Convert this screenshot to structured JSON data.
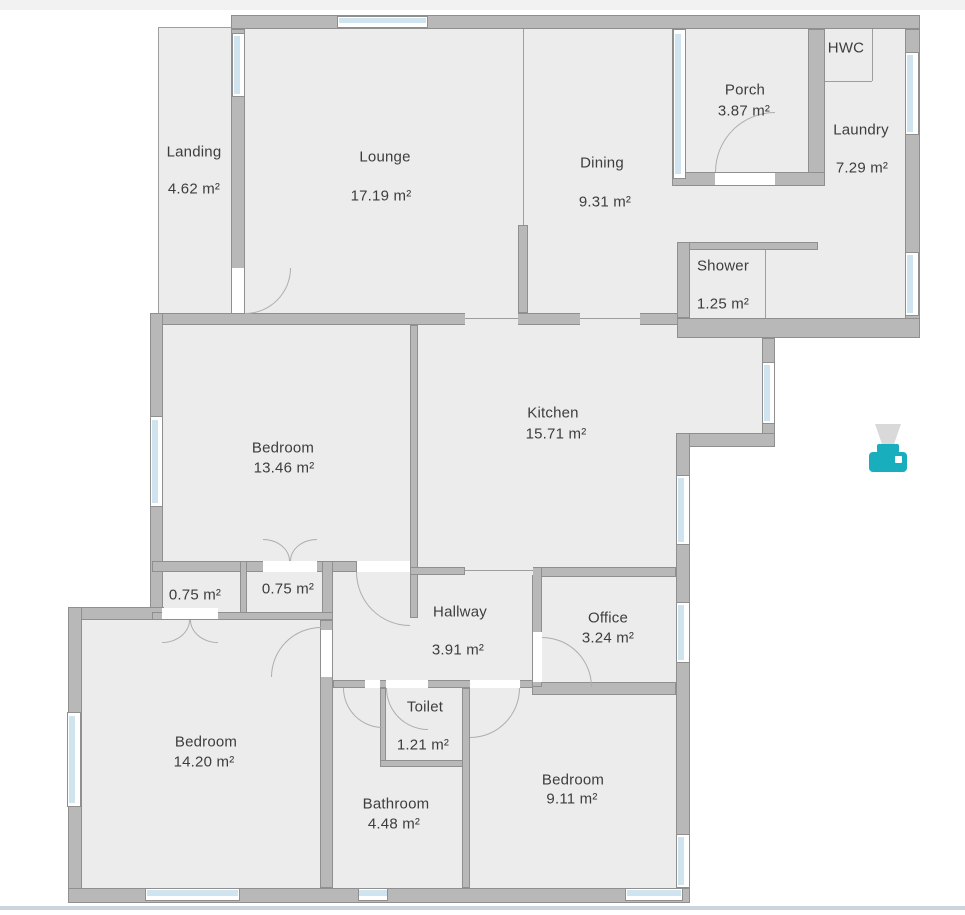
{
  "app": {
    "view": "floor-plan-canvas",
    "units": "m²"
  },
  "colors": {
    "floor": "#ececec",
    "wall": "#b8b8b8",
    "wall_border": "#8f8f8f",
    "window_glass": "#cfe4ee",
    "door_arc": "#aeaeae",
    "text": "#3d3d3d",
    "printer_teal": "#18aebe",
    "top_border": "#f2f2f2",
    "bottom_divider": "#ccd6da"
  },
  "rooms": [
    {
      "label": "Landing",
      "area": "4.62 m²",
      "lx": 194,
      "ly": 152,
      "ax": 194,
      "ay": 189
    },
    {
      "label": "Lounge",
      "area": "17.19 m²",
      "lx": 385,
      "ly": 157,
      "ax": 381,
      "ay": 196
    },
    {
      "label": "Dining",
      "area": "9.31 m²",
      "lx": 602,
      "ly": 163,
      "ax": 605,
      "ay": 202
    },
    {
      "label": "Porch",
      "area": "3.87 m²",
      "lx": 745,
      "ly": 90,
      "ax": 744,
      "ay": 111
    },
    {
      "label": "HWC",
      "area": "",
      "lx": 846,
      "ly": 48,
      "ax": 0,
      "ay": 0
    },
    {
      "label": "Laundry",
      "area": "7.29 m²",
      "lx": 861,
      "ly": 130,
      "ax": 862,
      "ay": 168
    },
    {
      "label": "Shower",
      "area": "1.25 m²",
      "lx": 723,
      "ly": 266,
      "ax": 723,
      "ay": 304
    },
    {
      "label": "Bedroom",
      "area": "13.46 m²",
      "lx": 283,
      "ly": 448,
      "ax": 284,
      "ay": 468
    },
    {
      "label": "Kitchen",
      "area": "15.71 m²",
      "lx": 553,
      "ly": 413,
      "ax": 556,
      "ay": 434
    },
    {
      "label": "",
      "area": "0.75 m²",
      "lx": 0,
      "ly": 0,
      "ax": 195,
      "ay": 595
    },
    {
      "label": "",
      "area": "0.75 m²",
      "lx": 0,
      "ly": 0,
      "ax": 288,
      "ay": 589
    },
    {
      "label": "Hallway",
      "area": "3.91 m²",
      "lx": 460,
      "ly": 612,
      "ax": 458,
      "ay": 650
    },
    {
      "label": "Office",
      "area": "3.24 m²",
      "lx": 608,
      "ly": 618,
      "ax": 608,
      "ay": 638
    },
    {
      "label": "Bedroom",
      "area": "14.20 m²",
      "lx": 206,
      "ly": 742,
      "ax": 204,
      "ay": 762
    },
    {
      "label": "Toilet",
      "area": "1.21 m²",
      "lx": 425,
      "ly": 707,
      "ax": 423,
      "ay": 745
    },
    {
      "label": "Bathroom",
      "area": "4.48 m²",
      "lx": 396,
      "ly": 804,
      "ax": 394,
      "ay": 824
    },
    {
      "label": "Bedroom",
      "area": "9.11 m²",
      "lx": 573,
      "ly": 780,
      "ax": 572,
      "ay": 799
    }
  ],
  "icons": [
    {
      "name": "printer-icon",
      "x": 866,
      "y": 422
    }
  ]
}
